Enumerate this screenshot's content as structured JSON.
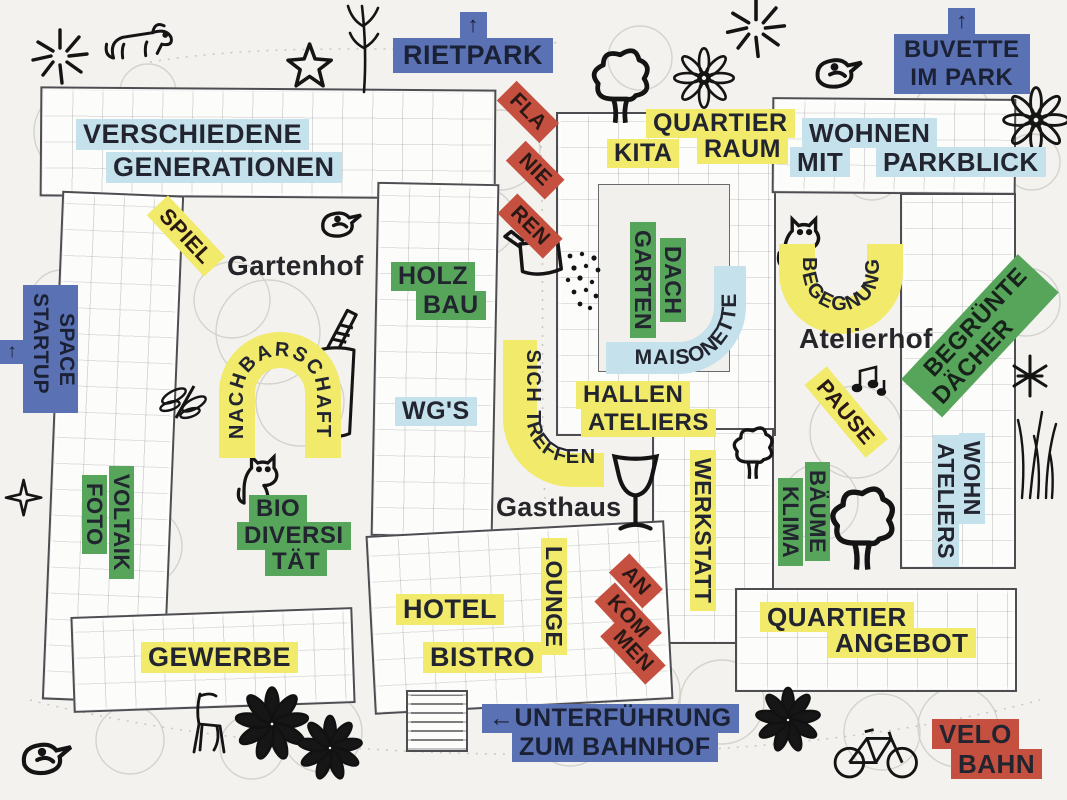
{
  "colors": {
    "paper": "#f3f2ef",
    "yellow": "#f1ea6b",
    "green": "#57a55a",
    "lightblue": "#c5e1ec",
    "blue": "#5a71b4",
    "red": "#c5503f",
    "ink": "#22252f"
  },
  "signs": {
    "rietpark": {
      "arrow": "↑",
      "label": "RIETPARK"
    },
    "buvette": {
      "arrow": "↑",
      "line1": "BUVETTE",
      "line2": "IM PARK"
    },
    "startup": {
      "arrow": "↑",
      "word1": "STARTUP",
      "word2": "SPACE"
    },
    "unterfuehrung": {
      "line1": "←UNTERFÜHRUNG",
      "line2": "ZUM BAHNHOF"
    },
    "velobahn": {
      "line1": "VELO",
      "line2": "BAHN"
    }
  },
  "areas": {
    "verschiedene_generationen": {
      "line1": "VERSCHIEDENE",
      "line2": "GENERATIONEN"
    },
    "flanieren": {
      "seg1": "FLA",
      "seg2": "NIE",
      "seg3": "REN"
    },
    "kita": {
      "text": "KITA"
    },
    "quartier_raum": {
      "line1": "QUARTIER",
      "line2": "RAUM"
    },
    "wohnen_mit_parkblick": {
      "line1": "WOHNEN",
      "line2a": "MIT",
      "line2b": "PARKBLICK"
    },
    "spiel": {
      "text": "SPIEL"
    },
    "holzbau": {
      "line1": "HOLZ",
      "line2": "BAU"
    },
    "nachbarschaft": {
      "text": "NACHBARSCHAFT"
    },
    "wgs": {
      "text": "WG'S"
    },
    "sich_treffen": {
      "text": "SICH TREFFEN"
    },
    "dachgarten": {
      "word1": "DACH",
      "word2": "GARTEN"
    },
    "maisonette": {
      "text": "MAISONETTE"
    },
    "hallen_ateliers": {
      "line1": "HALLEN",
      "line2": "ATELIERS"
    },
    "begegnung": {
      "text": "BEGEGNUNG"
    },
    "pause": {
      "text": "PAUSE"
    },
    "begruente_daecher": {
      "line1": "BEGRÜNTE",
      "line2": "DÄCHER"
    },
    "wohn_ateliers": {
      "word1": "WOHN",
      "word2": "ATELIERS"
    },
    "fotovoltaik": {
      "word1": "FOTO",
      "word2": "VOLTAIK"
    },
    "biodiversitaet": {
      "line1": "BIO",
      "line2": "DIVERSI",
      "line3": "TÄT"
    },
    "hotel": {
      "text": "HOTEL"
    },
    "bistro": {
      "text": "BISTRO"
    },
    "lounge": {
      "text": "LOUNGE"
    },
    "ankommen": {
      "seg1": "AN",
      "seg2": "KOM",
      "seg3": "MEN"
    },
    "werkstatt": {
      "text": "WERKSTATT"
    },
    "klima_baeume": {
      "word1": "KLIMA",
      "word2": "BÄUME"
    },
    "quartier_angebot": {
      "line1": "QUARTIER",
      "line2": "ANGEBOT"
    },
    "gewerbe": {
      "text": "GEWERBE"
    }
  },
  "places": {
    "gartenhof": "Gartenhof",
    "atelierhof": "Atelierhof",
    "gasthaus": "Gasthaus"
  },
  "doodles": [
    "dog",
    "starburst",
    "star",
    "plant-sprig",
    "tree",
    "flower",
    "bird",
    "watering-can",
    "water-drops",
    "drink-cup",
    "butterfly",
    "cat",
    "music-notes",
    "wine-glass",
    "grass",
    "asterisk-plant",
    "chair",
    "bicycle"
  ]
}
